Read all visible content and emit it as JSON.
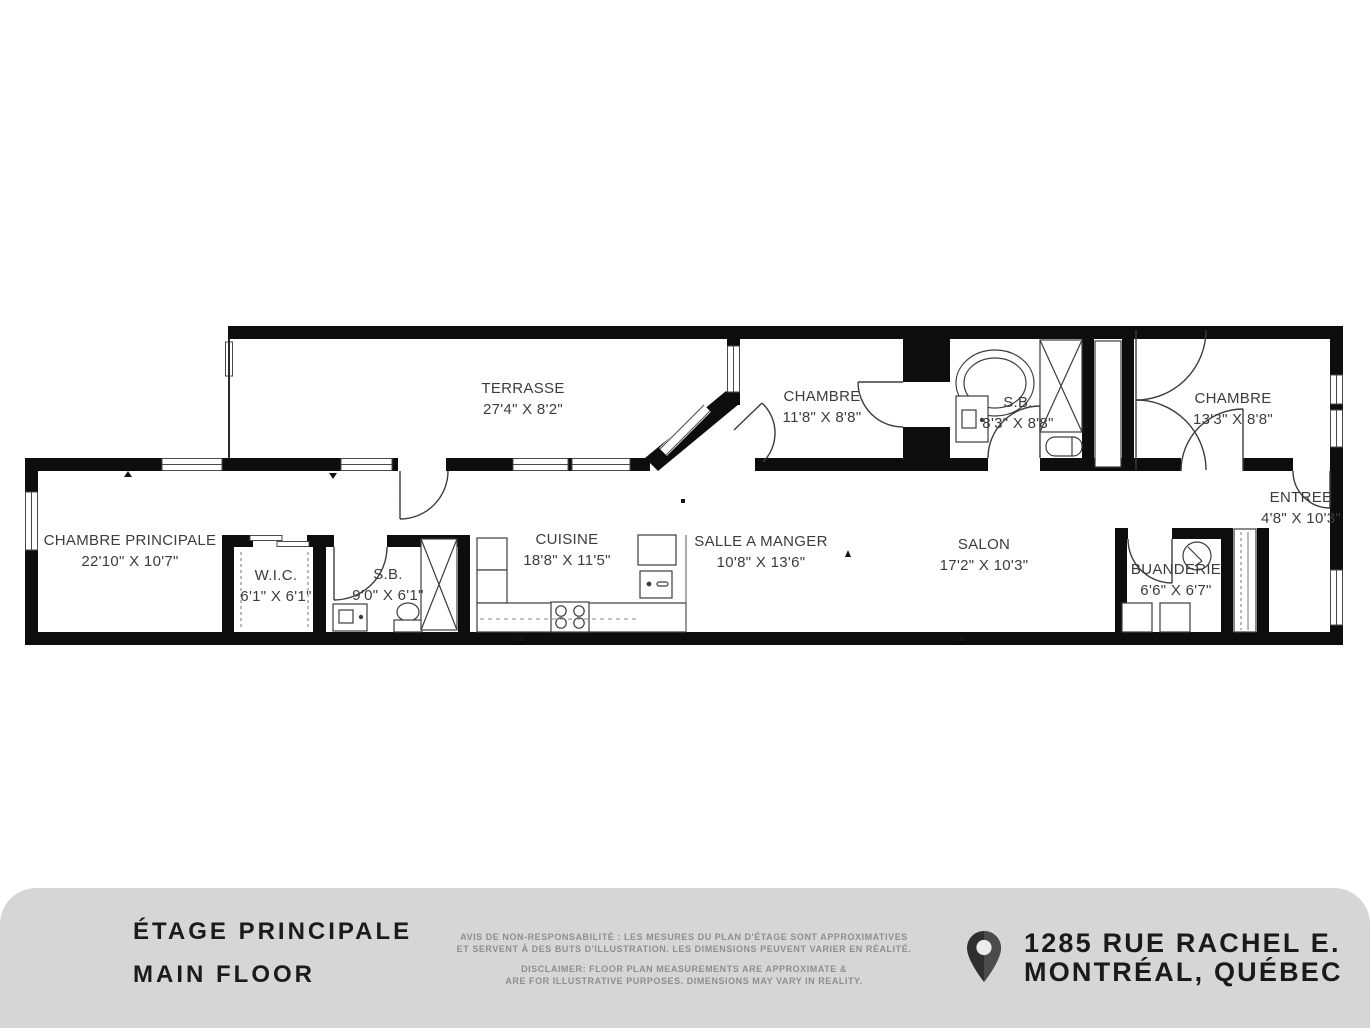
{
  "plan": {
    "rooms": [
      {
        "id": "terrasse",
        "name": "TERRASSE",
        "dims": "27'4\" X 8'2\""
      },
      {
        "id": "chambre-1",
        "name": "CHAMBRE",
        "dims": "11'8\" X 8'8\""
      },
      {
        "id": "sb-1",
        "name": "S.B.",
        "dims": "8'3\" X 8'8\""
      },
      {
        "id": "chambre-2",
        "name": "CHAMBRE",
        "dims": "13'3\" X 8'8\""
      },
      {
        "id": "entree",
        "name": "ENTREE",
        "dims": "4'8\" X 10'3\""
      },
      {
        "id": "chambre-principale",
        "name": "CHAMBRE PRINCIPALE",
        "dims": "22'10\" X 10'7\""
      },
      {
        "id": "wic",
        "name": "W.I.C.",
        "dims": "6'1\" X 6'1\""
      },
      {
        "id": "sb-2",
        "name": "S.B.",
        "dims": "9'0\" X 6'1\""
      },
      {
        "id": "cuisine",
        "name": "CUISINE",
        "dims": "18'8\" X 11'5\""
      },
      {
        "id": "salle-a-manger",
        "name": "SALLE A MANGER",
        "dims": "10'8\" X 13'6\""
      },
      {
        "id": "salon",
        "name": "SALON",
        "dims": "17'2\" X 10'3\""
      },
      {
        "id": "buanderie",
        "name": "BUANDERIE",
        "dims": "6'6\" X 6'7\""
      }
    ],
    "colors": {
      "wall": "#0d0d0d",
      "fixture_stroke": "#3d3d3d",
      "label_text": "#3c3c3c"
    }
  },
  "footer": {
    "title_fr": "ÉTAGE PRINCIPALE",
    "title_en": "MAIN FLOOR",
    "disclaimer_fr_1": "AVIS DE NON-RESPONSABILITÉ : LES MESURES DU PLAN D'ÉTAGE SONT APPROXIMATIVES",
    "disclaimer_fr_2": "ET SERVENT À DES BUTS D'ILLUSTRATION. LES DIMENSIONS PEUVENT VARIER EN RÉALITÉ.",
    "disclaimer_en_1": "DISCLAIMER: FLOOR PLAN MEASUREMENTS ARE APPROXIMATE &",
    "disclaimer_en_2": "ARE FOR ILLUSTRATIVE PURPOSES. DIMENSIONS MAY VARY IN REALITY.",
    "address_line1": "1285 RUE RACHEL E.",
    "address_line2": "MONTRÉAL, QUÉBEC",
    "pin_icon": "location-pin-icon",
    "colors": {
      "band": "#d6d6d6",
      "title": "#1b1b1b",
      "disclaimer": "#8e8e8e",
      "pin": "#333333"
    }
  }
}
